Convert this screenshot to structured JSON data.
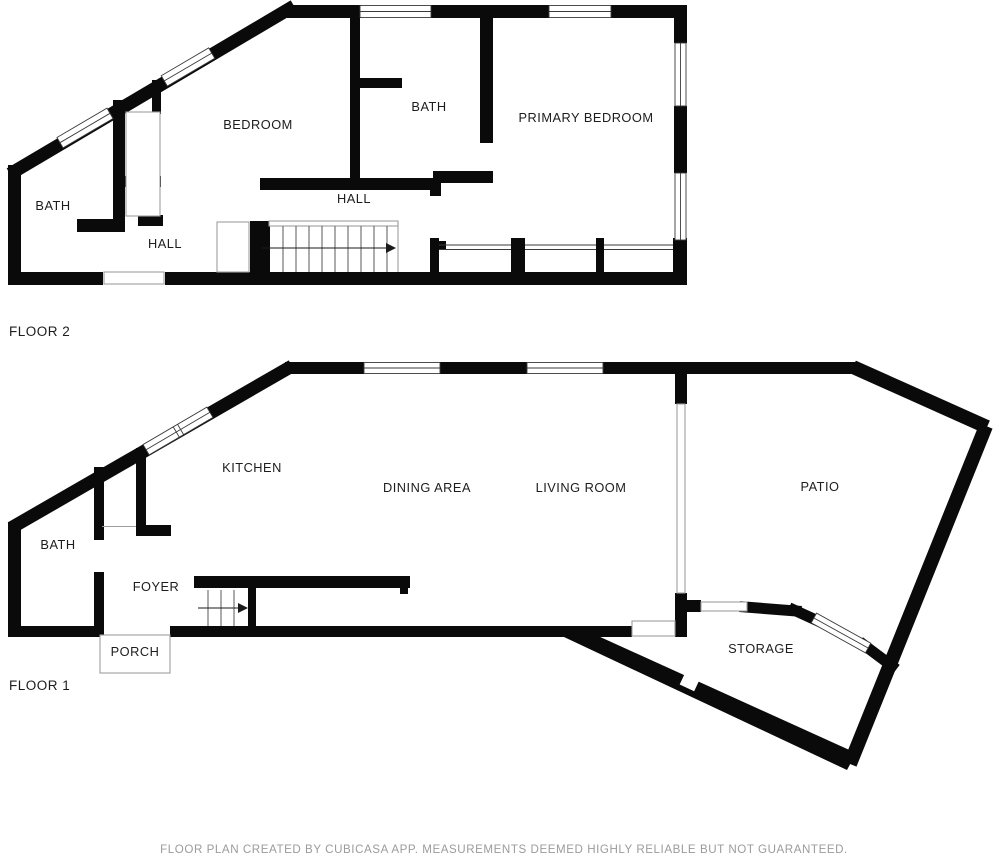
{
  "document_type": "floor-plan",
  "floor2": {
    "name": "FLOOR 2",
    "rooms": {
      "bath": "BATH",
      "hall_lower": "HALL",
      "bedroom": "BEDROOM",
      "bath_upper": "BATH",
      "primary_bedroom": "PRIMARY BEDROOM",
      "hall_upper": "HALL"
    }
  },
  "floor1": {
    "name": "FLOOR 1",
    "rooms": {
      "bath": "BATH",
      "foyer": "FOYER",
      "porch": "PORCH",
      "kitchen": "KITCHEN",
      "dining_area": "DINING AREA",
      "living_room": "LIVING ROOM",
      "patio": "PATIO",
      "storage": "STORAGE"
    }
  },
  "footer": {
    "disclaimer": "FLOOR PLAN CREATED BY CUBICASA APP. MEASUREMENTS DEEMED HIGHLY RELIABLE BUT NOT GUARANTEED."
  },
  "colors": {
    "background": "#ffffff",
    "wall": "#0a0a0a",
    "thin_outline": "#9e9e9e",
    "window_line": "#3a3a3a",
    "stair_line": "#5a5a5a",
    "label_text": "#1d1d1d",
    "footer_text": "#9b9b9b"
  }
}
